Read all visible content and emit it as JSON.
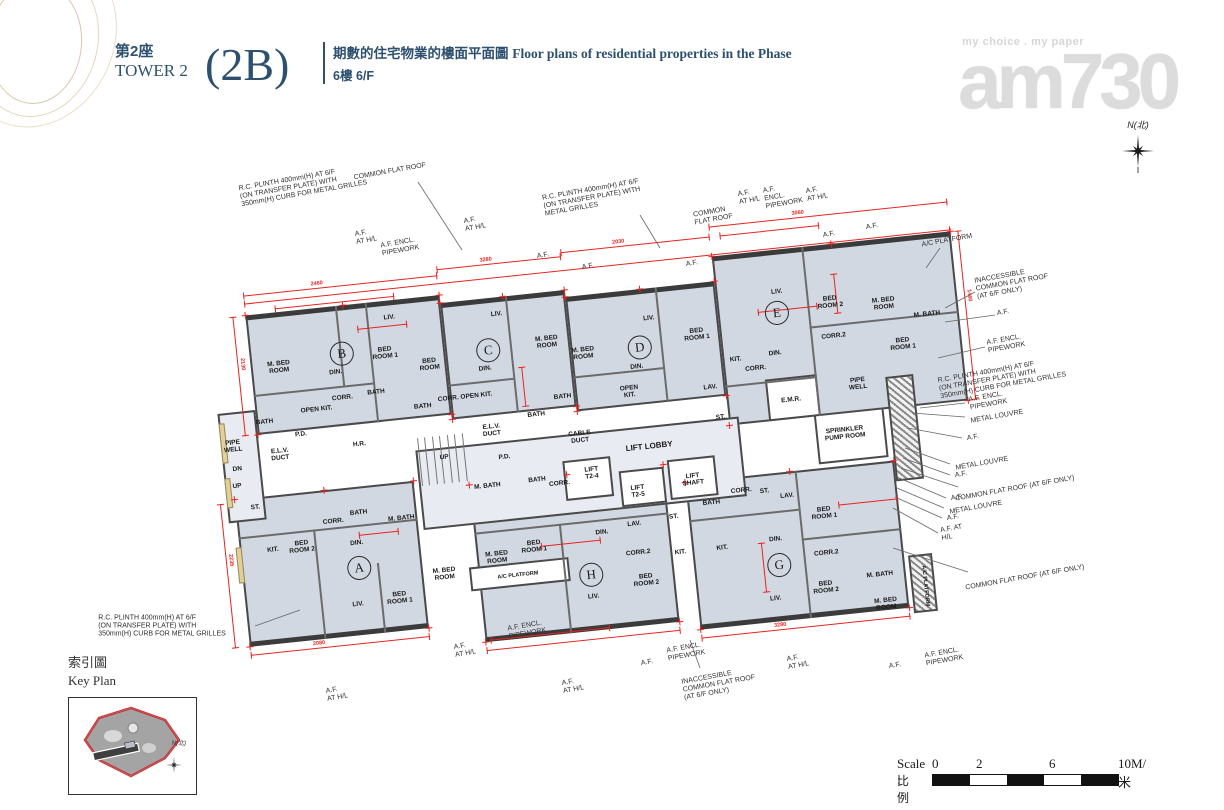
{
  "header": {
    "tower_zh": "第2座",
    "tower_en": "TOWER 2",
    "unit_code": "(2B)",
    "desc_zh": "期數的住宅物業的樓面平面圖",
    "desc_en": "Floor plans of residential properties in the Phase",
    "floor_zh": "6樓",
    "floor_en": "6/F"
  },
  "logo": {
    "tagline": "my choice . my paper",
    "name": "am730"
  },
  "north_label": "N(北)",
  "key_plan": {
    "title_zh": "索引圖",
    "title_en": "Key Plan",
    "north_label": "N(北)"
  },
  "scale_bar": {
    "label_en": "Scale :",
    "label_zh": "比例 :",
    "ticks": [
      "0",
      "2",
      "6",
      "10M/米"
    ],
    "segment_colors": [
      "#111111",
      "#ffffff",
      "#111111",
      "#ffffff",
      "#111111"
    ]
  },
  "plan": {
    "accent_red": "#e8231f",
    "floor_fill": "#d2d8e2",
    "wall_color": "#4a4a4a",
    "unit_circles": [
      {
        "id": "B",
        "x": 122,
        "y": 118
      },
      {
        "id": "C",
        "x": 268,
        "y": 130
      },
      {
        "id": "D",
        "x": 419,
        "y": 143
      },
      {
        "id": "E",
        "x": 559,
        "y": 123
      },
      {
        "id": "A",
        "x": 117,
        "y": 333
      },
      {
        "id": "H",
        "x": 347,
        "y": 364
      },
      {
        "id": "G",
        "x": 535,
        "y": 374
      }
    ],
    "room_labels": [
      {
        "t": "PIPE\nWELL",
        "x": 4,
        "y": 199
      },
      {
        "t": "BATH",
        "x": 38,
        "y": 178
      },
      {
        "t": "M. BED\nROOM",
        "x": 58,
        "y": 125
      },
      {
        "t": "LIV.",
        "x": 173,
        "y": 87
      },
      {
        "t": "DIN.",
        "x": 114,
        "y": 136
      },
      {
        "t": "BED\nROOM 1",
        "x": 165,
        "y": 122
      },
      {
        "t": "BED\nROOM",
        "x": 208,
        "y": 138
      },
      {
        "t": "BATH",
        "x": 152,
        "y": 160
      },
      {
        "t": "OPEN KIT.",
        "x": 91,
        "y": 171
      },
      {
        "t": "CORR.",
        "x": 118,
        "y": 162
      },
      {
        "t": "BATH",
        "x": 197,
        "y": 179
      },
      {
        "t": "P.D.",
        "x": 73,
        "y": 194
      },
      {
        "t": "H.R.",
        "x": 130,
        "y": 210
      },
      {
        "t": "E.L.V.\nDUCT",
        "x": 50,
        "y": 212
      },
      {
        "t": "DN",
        "x": 6,
        "y": 222
      },
      {
        "t": "UP",
        "x": 4,
        "y": 239
      },
      {
        "t": "ST.",
        "x": 20,
        "y": 262
      },
      {
        "t": "CORR. OPEN KIT.",
        "x": 240,
        "y": 174
      },
      {
        "t": "LIV.",
        "x": 280,
        "y": 95
      },
      {
        "t": "DIN.",
        "x": 263,
        "y": 148
      },
      {
        "t": "M. BED\nROOM",
        "x": 327,
        "y": 128
      },
      {
        "t": "BATH",
        "x": 337,
        "y": 184
      },
      {
        "t": "BATH",
        "x": 309,
        "y": 199
      },
      {
        "t": "E.L.V.\nDUCT",
        "x": 263,
        "y": 210
      },
      {
        "t": "CABLE\nDUCT",
        "x": 350,
        "y": 226
      },
      {
        "t": "M. BED\nROOM",
        "x": 362,
        "y": 143
      },
      {
        "t": "LIV.",
        "x": 431,
        "y": 115
      },
      {
        "t": "DIN.",
        "x": 414,
        "y": 162
      },
      {
        "t": "OPEN\nKIT.",
        "x": 404,
        "y": 186
      },
      {
        "t": "BED\nROOM 1",
        "x": 477,
        "y": 136
      },
      {
        "t": "KIT.",
        "x": 513,
        "y": 165
      },
      {
        "t": "CORR.",
        "x": 532,
        "y": 176
      },
      {
        "t": "LAV.",
        "x": 485,
        "y": 190
      },
      {
        "t": "ST.",
        "x": 492,
        "y": 221
      },
      {
        "t": "E.M.R.",
        "x": 564,
        "y": 211
      },
      {
        "t": "SPRINKLER\nPUMP ROOM",
        "x": 614,
        "y": 250
      },
      {
        "t": "PIPE\nWELL",
        "x": 632,
        "y": 202
      },
      {
        "t": "LIV.",
        "x": 561,
        "y": 102
      },
      {
        "t": "DIN.",
        "x": 553,
        "y": 163
      },
      {
        "t": "BED\nROOM 2",
        "x": 613,
        "y": 118
      },
      {
        "t": "CORR.2",
        "x": 613,
        "y": 152
      },
      {
        "t": "M. BED\nROOM",
        "x": 666,
        "y": 125
      },
      {
        "t": "BED\nROOM 1",
        "x": 681,
        "y": 167
      },
      {
        "t": "M. BATH",
        "x": 708,
        "y": 140
      },
      {
        "t": "LIFT LOBBY",
        "x": 418,
        "y": 243,
        "fs": 8
      },
      {
        "t": "LIFT\nT2-4",
        "x": 358,
        "y": 263
      },
      {
        "t": "LIFT\nT2-5",
        "x": 402,
        "y": 286
      },
      {
        "t": "LIFT\nSHAFT",
        "x": 458,
        "y": 280
      },
      {
        "t": "M. BATH",
        "x": 253,
        "y": 265
      },
      {
        "t": "BATH",
        "x": 303,
        "y": 264
      },
      {
        "t": "CORR.",
        "x": 325,
        "y": 270
      },
      {
        "t": "P.D.",
        "x": 273,
        "y": 238
      },
      {
        "t": "UP",
        "x": 213,
        "y": 232
      },
      {
        "t": "KIT.",
        "x": 33,
        "y": 306
      },
      {
        "t": "BED\nROOM 2",
        "x": 62,
        "y": 306
      },
      {
        "t": "CORR.",
        "x": 96,
        "y": 284
      },
      {
        "t": "BATH",
        "x": 122,
        "y": 278
      },
      {
        "t": "DIN.",
        "x": 117,
        "y": 308
      },
      {
        "t": "M. BATH",
        "x": 164,
        "y": 288
      },
      {
        "t": "LIV.",
        "x": 112,
        "y": 369
      },
      {
        "t": "BED\nROOM 1",
        "x": 154,
        "y": 367
      },
      {
        "t": "M. BED\nROOM",
        "x": 201,
        "y": 348
      },
      {
        "t": "M. BED\nROOM",
        "x": 255,
        "y": 337
      },
      {
        "t": "BED\nROOM 1",
        "x": 293,
        "y": 330
      },
      {
        "t": "DIN.",
        "x": 362,
        "y": 323
      },
      {
        "t": "LIV.",
        "x": 347,
        "y": 386
      },
      {
        "t": "BED\nROOM 2",
        "x": 401,
        "y": 375
      },
      {
        "t": "A/C PLATFORM",
        "x": 274,
        "y": 357,
        "fs": 5.5
      },
      {
        "t": "CORR.2",
        "x": 396,
        "y": 347
      },
      {
        "t": "LAV.",
        "x": 395,
        "y": 318
      },
      {
        "t": "ST.",
        "x": 435,
        "y": 315
      },
      {
        "t": "KIT.",
        "x": 438,
        "y": 351
      },
      {
        "t": "KIT.",
        "x": 480,
        "y": 351
      },
      {
        "t": "BATH",
        "x": 474,
        "y": 305
      },
      {
        "t": "CORR.",
        "x": 505,
        "y": 296
      },
      {
        "t": "ST.",
        "x": 528,
        "y": 299
      },
      {
        "t": "LAV.",
        "x": 550,
        "y": 306
      },
      {
        "t": "DIN.",
        "x": 534,
        "y": 348
      },
      {
        "t": "LIV.",
        "x": 528,
        "y": 407
      },
      {
        "t": "BED\nROOM 1",
        "x": 585,
        "y": 327
      },
      {
        "t": "CORR.2",
        "x": 583,
        "y": 367
      },
      {
        "t": "BED\nROOM 2",
        "x": 579,
        "y": 401
      },
      {
        "t": "M. BATH",
        "x": 634,
        "y": 394
      },
      {
        "t": "M. BED\nROOM",
        "x": 637,
        "y": 424
      },
      {
        "t": "A/C PLATFORM",
        "x": 678,
        "y": 410,
        "v": 1,
        "fs": 5.5
      }
    ],
    "dimension_values": [
      "2460",
      "3280",
      "2030",
      "3060",
      "2130",
      "1460",
      "2235",
      "2080"
    ],
    "dimension_lines": [
      {
        "x": 30,
        "y": 50,
        "l": 195,
        "n": "2460"
      },
      {
        "x": 225,
        "y": 44,
        "l": 125,
        "n": "3280"
      },
      {
        "x": 350,
        "y": 40,
        "l": 150,
        "n": "2030"
      },
      {
        "x": 500,
        "y": 30,
        "l": 240,
        "n": "3060"
      },
      {
        "x": 30,
        "y": 58,
        "l": 710
      },
      {
        "x": 18,
        "y": 70,
        "l": 120,
        "v": 1,
        "n": "2130"
      },
      {
        "x": 748,
        "y": 60,
        "l": 170,
        "v": 1,
        "n": "1460"
      },
      {
        "x": -14,
        "y": 255,
        "l": 145,
        "v": 1,
        "n": "2235"
      },
      {
        "x": 0,
        "y": 408,
        "l": 180,
        "n": "2080"
      },
      {
        "x": 235,
        "y": 428,
        "l": 195
      },
      {
        "x": 450,
        "y": 438,
        "l": 210,
        "n": "3280"
      },
      {
        "x": 140,
        "y": 95,
        "l": 50
      },
      {
        "x": 300,
        "y": 150,
        "l": 40,
        "v": 1
      },
      {
        "x": 540,
        "y": 120,
        "l": 60
      },
      {
        "x": 620,
        "y": 90,
        "l": 40,
        "v": 1
      },
      {
        "x": 300,
        "y": 330,
        "l": 60
      },
      {
        "x": 520,
        "y": 350,
        "l": 50,
        "v": 1
      },
      {
        "x": 120,
        "y": 300,
        "l": 40
      },
      {
        "x": 600,
        "y": 320,
        "l": 60
      },
      {
        "x": 60,
        "y": 66,
        "l": 120
      },
      {
        "x": 510,
        "y": 40,
        "l": 100
      },
      {
        "x": 240,
        "y": 418,
        "l": 120
      }
    ],
    "annotations": [
      {
        "t": "R.C. PLINTH 400mm(H) AT 6/F\n(ON TRANSFER PLATE) WITH\n350mm(H) CURB FOR METAL GRILLES",
        "x": 303,
        "y": 186
      },
      {
        "t": "COMMON FLAT ROOF",
        "x": 390,
        "y": 172,
        "leader": [
          418,
          182,
          462,
          250
        ]
      },
      {
        "t": "A.F.\nAT H/L",
        "x": 366,
        "y": 237
      },
      {
        "t": "A.F. ENCL.\nPIPEWORK",
        "x": 400,
        "y": 247
      },
      {
        "t": "A.F.\nAT H/L",
        "x": 475,
        "y": 224
      },
      {
        "t": "A.F.",
        "x": 543,
        "y": 256
      },
      {
        "t": "A.F.",
        "x": 588,
        "y": 267
      },
      {
        "t": "R.C. PLINTH 400mm(H) AT 6/F\n(ON TRANSFER PLATE) WITH\nMETAL GRILLES",
        "x": 592,
        "y": 198,
        "leader": [
          640,
          215,
          660,
          248
        ]
      },
      {
        "t": "COMMON\nFLAT ROOF",
        "x": 713,
        "y": 216
      },
      {
        "t": "A.F.\nAT H/L",
        "x": 749,
        "y": 197
      },
      {
        "t": "A.F.\nENCL.\nPIPEWORK",
        "x": 783,
        "y": 196
      },
      {
        "t": "A.F.\nAT H/L",
        "x": 817,
        "y": 194
      },
      {
        "t": "A.F.",
        "x": 829,
        "y": 235
      },
      {
        "t": "A.F.",
        "x": 872,
        "y": 227
      },
      {
        "t": "A.F.",
        "x": 692,
        "y": 264
      },
      {
        "t": "A/C PLATFORM",
        "x": 947,
        "y": 241,
        "leader": [
          940,
          248,
          926,
          268
        ]
      },
      {
        "t": "INACCESSIBLE\nCOMMON FLAT ROOF\n(AT 6/F ONLY)",
        "x": 1012,
        "y": 283,
        "leader": [
          975,
          292,
          945,
          308
        ]
      },
      {
        "t": "A.F.",
        "x": 1003,
        "y": 313,
        "leader": [
          995,
          315,
          945,
          322
        ]
      },
      {
        "t": "A.F. ENCL.\nPIPEWORK",
        "x": 1006,
        "y": 344,
        "leader": [
          985,
          347,
          938,
          358
        ]
      },
      {
        "t": "R.C. PLINTH 400mm(H) AT 6/F\n(ON TRANSFER PLATE) WITH\n350mm(H) CURB FOR METAL GRILLES",
        "x": 1002,
        "y": 378
      },
      {
        "t": "A.F. ENCL.\nPIPEWORK",
        "x": 988,
        "y": 401,
        "leader": [
          965,
          403,
          920,
          408
        ]
      },
      {
        "t": "METAL LOUVRE",
        "x": 997,
        "y": 417,
        "leader": [
          965,
          417,
          912,
          413
        ]
      },
      {
        "t": "A.F.",
        "x": 973,
        "y": 438,
        "leader": [
          962,
          438,
          908,
          428
        ]
      },
      {
        "t": "METAL LOUVRE",
        "x": 982,
        "y": 464,
        "leader": [
          950,
          464,
          905,
          448
        ]
      },
      {
        "t": "A.F.",
        "x": 961,
        "y": 475,
        "leader": [
          950,
          475,
          903,
          458
        ]
      },
      {
        "t": "COMMON FLAT ROOF (AT 6/F ONLY)",
        "x": 1015,
        "y": 489,
        "leader": [
          958,
          487,
          901,
          468
        ]
      },
      {
        "t": "A.F.",
        "x": 957,
        "y": 498,
        "leader": [
          946,
          498,
          899,
          478
        ]
      },
      {
        "t": "METAL LOUVRE",
        "x": 976,
        "y": 508,
        "leader": [
          944,
          508,
          897,
          488
        ]
      },
      {
        "t": "A.F.",
        "x": 953,
        "y": 518,
        "leader": [
          942,
          518,
          895,
          497
        ]
      },
      {
        "t": "A.F. AT\nH/L",
        "x": 952,
        "y": 533,
        "leader": [
          938,
          533,
          893,
          508
        ]
      },
      {
        "t": "COMMON FLAT ROOF (AT 6/F ONLY)",
        "x": 1025,
        "y": 578,
        "leader": [
          968,
          572,
          893,
          548
        ]
      },
      {
        "t": "A.F. ENCL.\nPIPEWORK",
        "x": 944,
        "y": 657
      },
      {
        "t": "A.F.",
        "x": 895,
        "y": 666
      },
      {
        "t": "INACCESSIBLE\nCOMMON FLAT ROOF\n(AT 6/F ONLY)",
        "x": 719,
        "y": 684,
        "leader": [
          700,
          668,
          690,
          640
        ]
      },
      {
        "t": "A.F.\nAT H/L",
        "x": 798,
        "y": 662
      },
      {
        "t": "A.F.",
        "x": 647,
        "y": 663
      },
      {
        "t": "A.F. ENCL.\nPIPEWORK",
        "x": 686,
        "y": 652
      },
      {
        "t": "A.F. ENCL.\nPIPEWORK",
        "x": 527,
        "y": 630
      },
      {
        "t": "A.F.\nAT H/L",
        "x": 465,
        "y": 650
      },
      {
        "t": "A.F.\nAT H/L",
        "x": 573,
        "y": 686
      },
      {
        "t": "A.F.\nAT H/L",
        "x": 337,
        "y": 694
      },
      {
        "t": "R.C. PLINTH 400mm(H) AT 6/F\n(ON TRANSFER PLATE) WITH\n350mm(H) CURB FOR METAL GRILLES",
        "x": 162,
        "y": 626,
        "r0": true,
        "leader": [
          255,
          626,
          300,
          610
        ]
      }
    ]
  }
}
